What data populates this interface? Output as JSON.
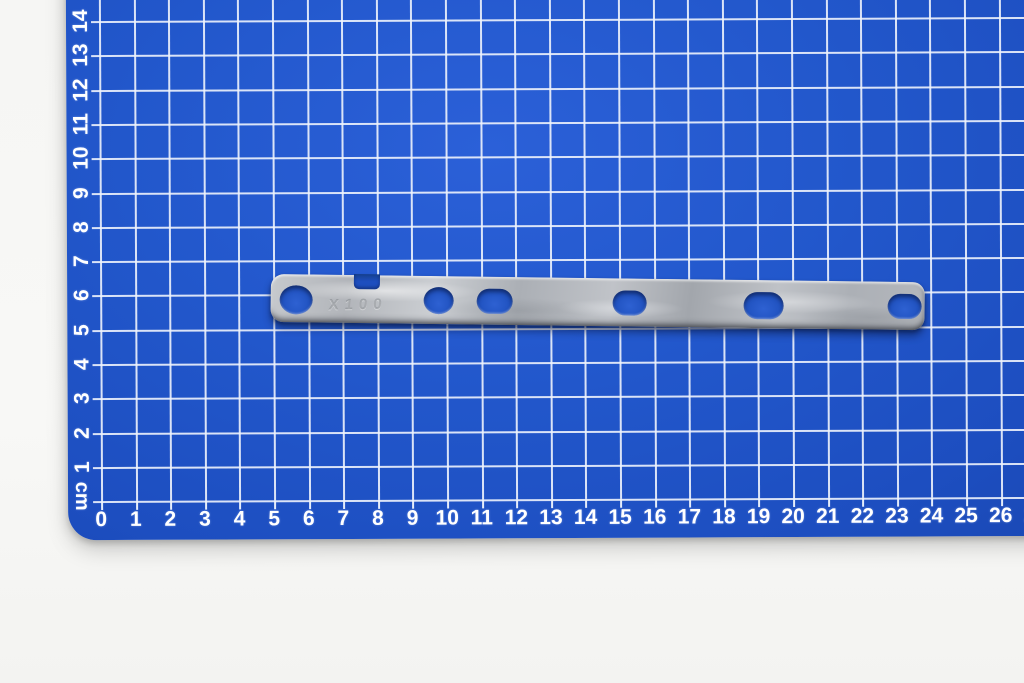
{
  "scene": {
    "type": "photograph",
    "subject": "galvanized flat metal bracket strip lying on a blue self-healing cutting mat with centimetre grid",
    "background_color": "#f7f7f5"
  },
  "mat": {
    "surface_color": "#1e4fc0",
    "grid_color": "#eef3fc",
    "label_color": "#ffffff",
    "unit_label": "cm",
    "bottom_scale": [
      "0",
      "1",
      "2",
      "3",
      "4",
      "5",
      "6",
      "7",
      "8",
      "9",
      "10",
      "11",
      "12",
      "13",
      "14",
      "15",
      "16",
      "17",
      "18",
      "19",
      "20",
      "21",
      "22",
      "23",
      "24",
      "25",
      "26",
      "27"
    ],
    "left_scale": [
      "14",
      "13",
      "12",
      "11",
      "10",
      "9",
      "8",
      "7",
      "6",
      "5",
      "4",
      "3",
      "2",
      "1"
    ]
  },
  "strip": {
    "material_color": "#b5b8bd",
    "hole_color": "#2254c2",
    "stamp": "X100",
    "notch": {
      "x": 83,
      "w": 26,
      "h": 15
    },
    "holes": [
      {
        "cx": 25,
        "cy": 25,
        "w": 33,
        "h": 29,
        "shape": "round"
      },
      {
        "cx": 168,
        "cy": 24,
        "w": 30,
        "h": 27,
        "shape": "round"
      },
      {
        "cx": 224,
        "cy": 24,
        "w": 36,
        "h": 25,
        "shape": "slot"
      },
      {
        "cx": 359,
        "cy": 24,
        "w": 34,
        "h": 25,
        "shape": "slot"
      },
      {
        "cx": 493,
        "cy": 25,
        "w": 40,
        "h": 27,
        "shape": "slot"
      },
      {
        "cx": 634,
        "cy": 24,
        "w": 34,
        "h": 25,
        "shape": "slot"
      }
    ]
  }
}
